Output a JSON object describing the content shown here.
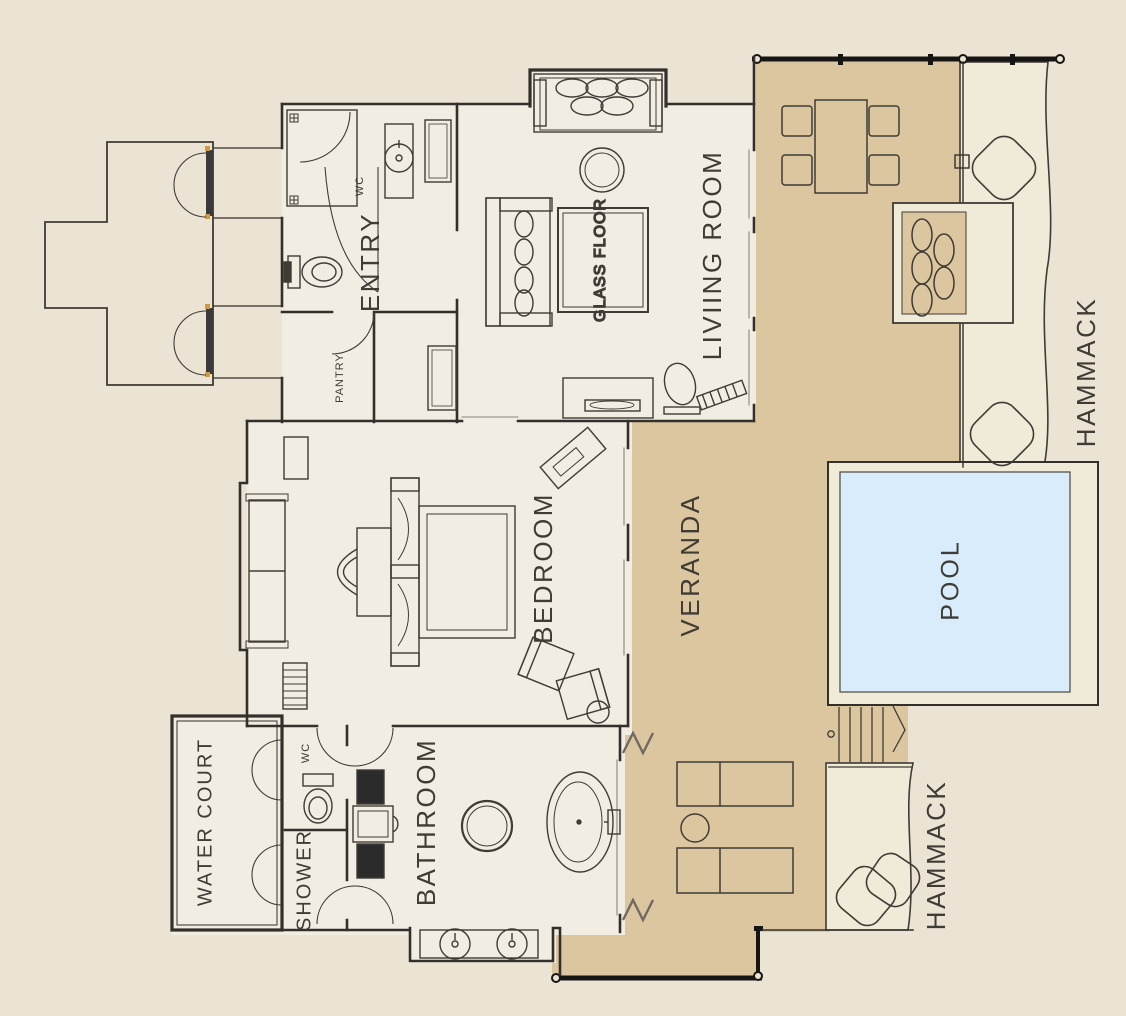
{
  "plan": {
    "title": "villa-floor-plan",
    "labels": {
      "entry": "ENTRY",
      "living_room": "LIVIING ROOM",
      "glass_floor": "GLASS FLOOR",
      "bedroom": "BEDROOM",
      "veranda": "VERANDA",
      "pool": "POOL",
      "bathroom": "BATHROOM",
      "water_court": "WATER COURT",
      "shower": "SHOWER",
      "wc_entry": "WC",
      "wc_bath": "WC",
      "pantry": "PANTRY",
      "hammack_right": "HAMMACK",
      "hammack_bottom": "HAMMACK"
    },
    "colors": {
      "canvas": "#ebe3d4",
      "floor": "#f2ede2",
      "veranda": "#dcc69f",
      "deck": "#f0ead9",
      "pool": "#d9ecfb",
      "wall": "#332f2a",
      "furniture": "#3f3b35",
      "railing": "#171513",
      "accent": "#d29a3a"
    }
  }
}
